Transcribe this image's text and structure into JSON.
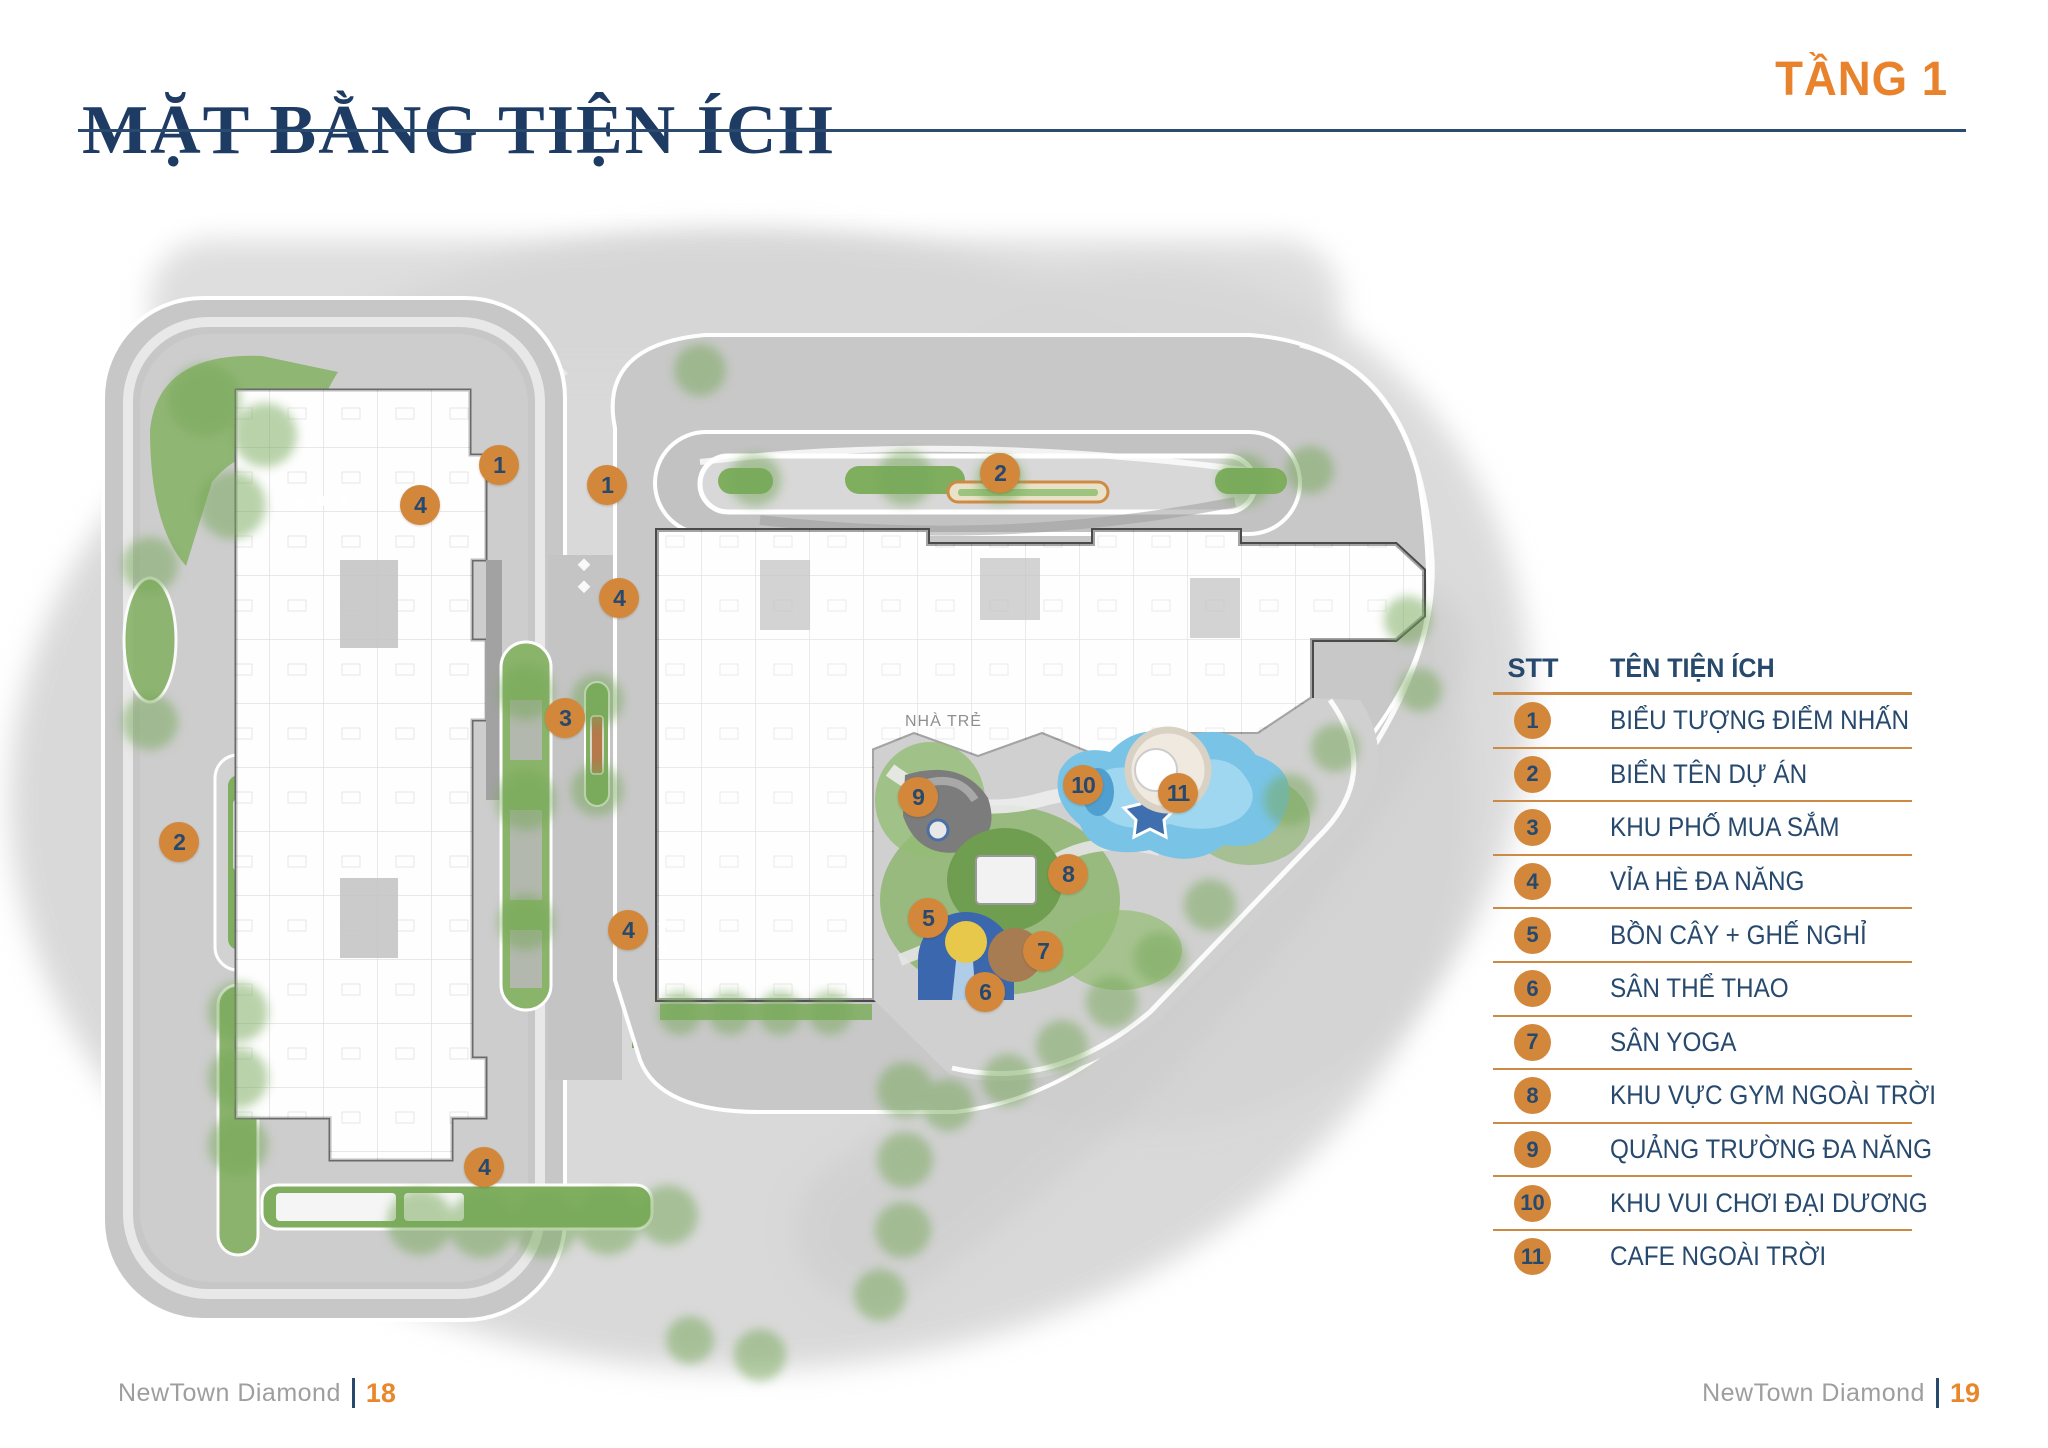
{
  "page": {
    "title": "MẶT BẰNG TIỆN ÍCH",
    "floor_label": "TẦNG 1"
  },
  "colors": {
    "accent_orange": "#D2873B",
    "bright_orange": "#E8822C",
    "navy": "#27496D",
    "divider_orange": "#CC8A45",
    "pool_blue": "#79C4E6",
    "green": "#7FAE5F"
  },
  "legend": {
    "header": {
      "stt": "STT",
      "name": "TÊN TIỆN ÍCH"
    },
    "rows": [
      {
        "num": "1",
        "label": "BIỂU TƯỢNG ĐIỂM NHẤN"
      },
      {
        "num": "2",
        "label": "BIỂN TÊN DỰ ÁN"
      },
      {
        "num": "3",
        "label": "KHU PHỐ MUA SẮM"
      },
      {
        "num": "4",
        "label": "VỈA HÈ ĐA NĂNG"
      },
      {
        "num": "5",
        "label": "BỒN CÂY + GHẾ NGHỈ"
      },
      {
        "num": "6",
        "label": "SÂN THỂ THAO"
      },
      {
        "num": "7",
        "label": "SÂN YOGA"
      },
      {
        "num": "8",
        "label": "KHU VỰC GYM NGOÀI TRỜI"
      },
      {
        "num": "9",
        "label": "QUẢNG TRƯỜNG ĐA NĂNG"
      },
      {
        "num": "10",
        "label": "KHU VUI CHƠI ĐẠI DƯƠNG"
      },
      {
        "num": "11",
        "label": "CAFE NGOÀI TRỜI"
      }
    ]
  },
  "plan": {
    "building_label": "NHÀ TRẺ",
    "markers": [
      {
        "num": "1",
        "x": 499,
        "y": 465
      },
      {
        "num": "4",
        "x": 420,
        "y": 505
      },
      {
        "num": "1",
        "x": 607,
        "y": 485
      },
      {
        "num": "2",
        "x": 1000,
        "y": 473
      },
      {
        "num": "4",
        "x": 619,
        "y": 598
      },
      {
        "num": "3",
        "x": 565,
        "y": 718
      },
      {
        "num": "2",
        "x": 179,
        "y": 842
      },
      {
        "num": "4",
        "x": 628,
        "y": 930
      },
      {
        "num": "9",
        "x": 918,
        "y": 797
      },
      {
        "num": "10",
        "x": 1083,
        "y": 785
      },
      {
        "num": "11",
        "x": 1178,
        "y": 793
      },
      {
        "num": "8",
        "x": 1068,
        "y": 874
      },
      {
        "num": "5",
        "x": 928,
        "y": 918
      },
      {
        "num": "7",
        "x": 1043,
        "y": 951
      },
      {
        "num": "6",
        "x": 985,
        "y": 992
      },
      {
        "num": "4",
        "x": 484,
        "y": 1167
      }
    ]
  },
  "footer": {
    "left": {
      "brand": "NewTown Diamond",
      "page": "18"
    },
    "right": {
      "brand": "NewTown Diamond",
      "page": "19"
    }
  }
}
